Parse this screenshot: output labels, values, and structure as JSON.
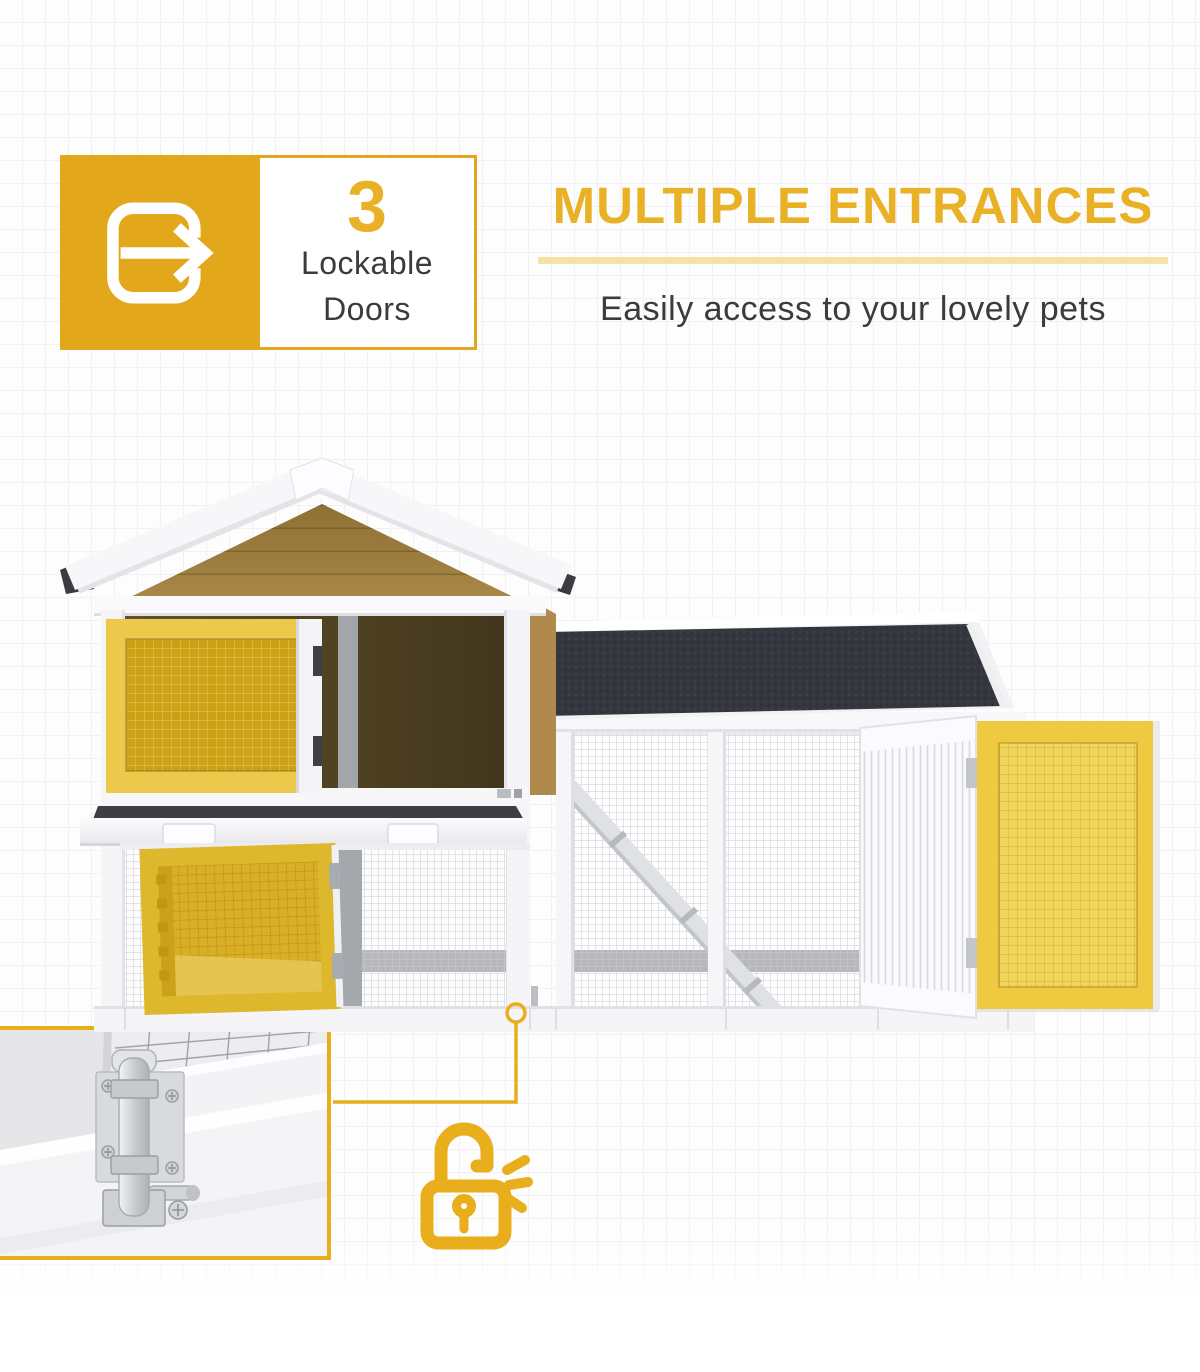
{
  "badge": {
    "count": "3",
    "label_lines": [
      "Lockable",
      "Doors"
    ],
    "icon": "enter-arrow-icon"
  },
  "header": {
    "title": "MULTIPLE ENTRANCES",
    "subtitle": "Easily access to your lovely pets"
  },
  "icons": {
    "badge_icon": "enter-arrow-icon",
    "lock_icon": "unlocked-padlock-icon"
  },
  "colors": {
    "accent_gold": "#E2A71B",
    "heading_yellow": "#E9B125",
    "underline_yellow": "#F6E2A6",
    "text_dark": "#3B3B3B",
    "roof_black": "#35383E",
    "gable_wood": "#9D7C3E",
    "door_gold_frame": "#EFC93F",
    "door_gold_mesh": "#CDA115",
    "callout_yellow": "#E8AE1B"
  }
}
